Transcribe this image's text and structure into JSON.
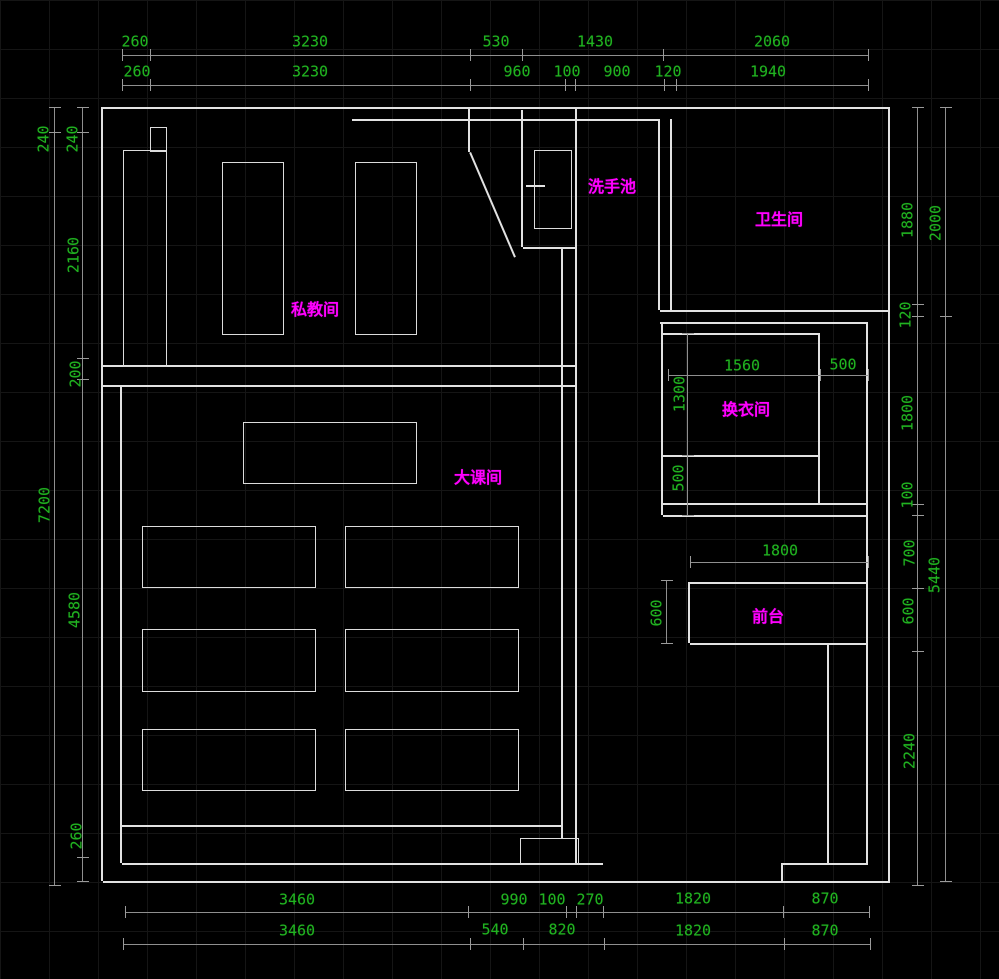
{
  "app": {
    "type": "cad-floor-plan",
    "units": "mm"
  },
  "colors": {
    "background": "#000000",
    "grid": "#151515",
    "wall": "#e2e2e2",
    "dim_line": "#8f8f8f",
    "dim_text": "#21b321",
    "room_label": "#ff00ff"
  },
  "rooms": [
    {
      "key": "private-training-room",
      "label": "私教间",
      "x": 315,
      "y": 310
    },
    {
      "key": "group-class-room",
      "label": "大课间",
      "x": 478,
      "y": 478
    },
    {
      "key": "wash-basin",
      "label": "洗手池",
      "x": 612,
      "y": 187
    },
    {
      "key": "toilet",
      "label": "卫生间",
      "x": 779,
      "y": 220
    },
    {
      "key": "changing-room",
      "label": "换衣间",
      "x": 746,
      "y": 410
    },
    {
      "key": "front-desk",
      "label": "前台",
      "x": 768,
      "y": 617
    }
  ],
  "dim_labels": [
    {
      "group": "top-outer",
      "text": "260",
      "x": 135,
      "y": 42,
      "rot": false
    },
    {
      "group": "top-outer",
      "text": "3230",
      "x": 310,
      "y": 42,
      "rot": false
    },
    {
      "group": "top-outer",
      "text": "530",
      "x": 496,
      "y": 42,
      "rot": false
    },
    {
      "group": "top-outer",
      "text": "1430",
      "x": 595,
      "y": 42,
      "rot": false
    },
    {
      "group": "top-outer",
      "text": "2060",
      "x": 772,
      "y": 42,
      "rot": false
    },
    {
      "group": "top-inner",
      "text": "260",
      "x": 137,
      "y": 72,
      "rot": false
    },
    {
      "group": "top-inner",
      "text": "3230",
      "x": 310,
      "y": 72,
      "rot": false
    },
    {
      "group": "top-inner",
      "text": "960",
      "x": 517,
      "y": 72,
      "rot": false
    },
    {
      "group": "top-inner",
      "text": "100",
      "x": 567,
      "y": 72,
      "rot": false
    },
    {
      "group": "top-inner",
      "text": "900",
      "x": 617,
      "y": 72,
      "rot": false
    },
    {
      "group": "top-inner",
      "text": "120",
      "x": 668,
      "y": 72,
      "rot": false
    },
    {
      "group": "top-inner",
      "text": "1940",
      "x": 768,
      "y": 72,
      "rot": false
    },
    {
      "group": "bottom-upper",
      "text": "3460",
      "x": 297,
      "y": 900,
      "rot": false
    },
    {
      "group": "bottom-upper",
      "text": "990",
      "x": 514,
      "y": 900,
      "rot": false
    },
    {
      "group": "bottom-upper",
      "text": "100",
      "x": 552,
      "y": 900,
      "rot": false
    },
    {
      "group": "bottom-upper",
      "text": "270",
      "x": 590,
      "y": 900,
      "rot": false
    },
    {
      "group": "bottom-upper",
      "text": "1820",
      "x": 693,
      "y": 899,
      "rot": false
    },
    {
      "group": "bottom-upper",
      "text": "870",
      "x": 825,
      "y": 899,
      "rot": false
    },
    {
      "group": "bottom-lower",
      "text": "3460",
      "x": 297,
      "y": 931,
      "rot": false
    },
    {
      "group": "bottom-lower",
      "text": "540",
      "x": 495,
      "y": 930,
      "rot": false
    },
    {
      "group": "bottom-lower",
      "text": "820",
      "x": 562,
      "y": 930,
      "rot": false
    },
    {
      "group": "bottom-lower",
      "text": "1820",
      "x": 693,
      "y": 931,
      "rot": false
    },
    {
      "group": "bottom-lower",
      "text": "870",
      "x": 825,
      "y": 931,
      "rot": false
    },
    {
      "group": "left-outer",
      "text": "240",
      "x": 44,
      "y": 139,
      "rot": true
    },
    {
      "group": "left-outer",
      "text": "7200",
      "x": 45,
      "y": 505,
      "rot": true
    },
    {
      "group": "left-inner",
      "text": "240",
      "x": 73,
      "y": 139,
      "rot": true
    },
    {
      "group": "left-inner",
      "text": "2160",
      "x": 74,
      "y": 255,
      "rot": true
    },
    {
      "group": "left-inner",
      "text": "200",
      "x": 76,
      "y": 374,
      "rot": true
    },
    {
      "group": "left-inner",
      "text": "4580",
      "x": 75,
      "y": 610,
      "rot": true
    },
    {
      "group": "left-inner",
      "text": "260",
      "x": 77,
      "y": 836,
      "rot": true
    },
    {
      "group": "right-inner",
      "text": "1880",
      "x": 908,
      "y": 220,
      "rot": true
    },
    {
      "group": "right-inner",
      "text": "120",
      "x": 906,
      "y": 315,
      "rot": true
    },
    {
      "group": "right-inner",
      "text": "1800",
      "x": 908,
      "y": 413,
      "rot": true
    },
    {
      "group": "right-inner",
      "text": "100",
      "x": 908,
      "y": 495,
      "rot": true
    },
    {
      "group": "right-inner",
      "text": "700",
      "x": 910,
      "y": 553,
      "rot": true
    },
    {
      "group": "right-inner",
      "text": "600",
      "x": 909,
      "y": 611,
      "rot": true
    },
    {
      "group": "right-inner",
      "text": "2240",
      "x": 910,
      "y": 751,
      "rot": true
    },
    {
      "group": "right-outer",
      "text": "2000",
      "x": 936,
      "y": 223,
      "rot": true
    },
    {
      "group": "right-outer",
      "text": "5440",
      "x": 935,
      "y": 575,
      "rot": true
    },
    {
      "group": "interior",
      "text": "1560",
      "x": 742,
      "y": 366,
      "rot": false
    },
    {
      "group": "interior",
      "text": "500",
      "x": 843,
      "y": 365,
      "rot": false
    },
    {
      "group": "interior",
      "text": "1300",
      "x": 680,
      "y": 394,
      "rot": true
    },
    {
      "group": "interior",
      "text": "500",
      "x": 679,
      "y": 478,
      "rot": true
    },
    {
      "group": "interior",
      "text": "1800",
      "x": 780,
      "y": 551,
      "rot": false
    },
    {
      "group": "interior",
      "text": "600",
      "x": 657,
      "y": 613,
      "rot": true
    }
  ],
  "dim_lines": [
    {
      "x1": 122,
      "y1": 55,
      "x2": 868,
      "y2": 55,
      "ticks": [
        122,
        150,
        470,
        522,
        663,
        868
      ]
    },
    {
      "x1": 122,
      "y1": 85,
      "x2": 868,
      "y2": 85,
      "ticks": [
        122,
        150,
        470,
        565,
        575,
        664,
        676,
        868
      ]
    },
    {
      "x1": 125,
      "y1": 912,
      "x2": 869,
      "y2": 912,
      "ticks": [
        125,
        468,
        566,
        576,
        603,
        783,
        869
      ]
    },
    {
      "x1": 123,
      "y1": 944,
      "x2": 870,
      "y2": 944,
      "ticks": [
        123,
        470,
        523,
        604,
        784,
        870
      ]
    },
    {
      "x1": 55,
      "y1": 107,
      "x2": 55,
      "y2": 885,
      "ticks": [
        107,
        132,
        885
      ]
    },
    {
      "x1": 83,
      "y1": 107,
      "x2": 83,
      "y2": 881,
      "ticks": [
        107,
        132,
        358,
        379,
        857,
        881
      ]
    },
    {
      "x1": 918,
      "y1": 107,
      "x2": 918,
      "y2": 885,
      "ticks": [
        107,
        304,
        316,
        504,
        515,
        588,
        651,
        885
      ]
    },
    {
      "x1": 946,
      "y1": 107,
      "x2": 946,
      "y2": 881,
      "ticks": [
        107,
        316,
        881
      ]
    },
    {
      "x1": 668,
      "y1": 375,
      "x2": 868,
      "y2": 375,
      "ticks": [
        668,
        820,
        868
      ]
    },
    {
      "x1": 688,
      "y1": 333,
      "x2": 688,
      "y2": 515,
      "ticks": [
        333,
        455,
        515
      ]
    },
    {
      "x1": 690,
      "y1": 562,
      "x2": 868,
      "y2": 562,
      "ticks": [
        690,
        868
      ]
    },
    {
      "x1": 667,
      "y1": 580,
      "x2": 667,
      "y2": 643,
      "ticks": [
        580,
        643
      ]
    }
  ],
  "walls": [
    [
      103,
      107,
      890,
      107
    ],
    [
      890,
      107,
      890,
      881
    ],
    [
      103,
      881,
      890,
      881
    ],
    [
      103,
      107,
      103,
      881
    ],
    [
      103,
      365,
      577,
      365
    ],
    [
      103,
      385,
      577,
      385
    ],
    [
      577,
      107,
      577,
      863
    ],
    [
      563,
      248,
      563,
      838
    ],
    [
      523,
      110,
      523,
      247
    ],
    [
      523,
      247,
      577,
      247
    ],
    [
      471,
      152,
      516,
      257
    ],
    [
      470,
      107,
      470,
      152
    ],
    [
      526,
      185,
      545,
      185
    ],
    [
      352,
      119,
      660,
      119
    ],
    [
      660,
      119,
      660,
      310
    ],
    [
      672,
      119,
      672,
      310
    ],
    [
      660,
      310,
      890,
      310
    ],
    [
      660,
      322,
      868,
      322
    ],
    [
      663,
      322,
      663,
      515
    ],
    [
      820,
      333,
      820,
      503
    ],
    [
      663,
      333,
      820,
      333
    ],
    [
      663,
      455,
      820,
      455
    ],
    [
      663,
      503,
      868,
      503
    ],
    [
      663,
      515,
      868,
      515
    ],
    [
      868,
      322,
      868,
      863
    ],
    [
      690,
      582,
      868,
      582
    ],
    [
      690,
      582,
      690,
      643
    ],
    [
      690,
      643,
      868,
      643
    ],
    [
      829,
      643,
      829,
      863
    ],
    [
      122,
      385,
      122,
      863
    ],
    [
      122,
      825,
      563,
      825
    ],
    [
      122,
      863,
      603,
      863
    ],
    [
      783,
      863,
      868,
      863
    ],
    [
      783,
      863,
      783,
      881
    ]
  ],
  "fixtures": [
    {
      "name": "wall-column",
      "x": 123,
      "y": 150,
      "w": 42,
      "h": 215
    },
    {
      "name": "wall-notch",
      "x": 150,
      "y": 127,
      "w": 15,
      "h": 23
    },
    {
      "name": "equipment-rect-1",
      "x": 222,
      "y": 162,
      "w": 60,
      "h": 171
    },
    {
      "name": "equipment-rect-2",
      "x": 355,
      "y": 162,
      "w": 60,
      "h": 171
    },
    {
      "name": "basin-door",
      "x": 534,
      "y": 150,
      "w": 36,
      "h": 77
    },
    {
      "name": "class-mat-top",
      "x": 243,
      "y": 422,
      "w": 172,
      "h": 60
    },
    {
      "name": "class-mat-r1c1",
      "x": 142,
      "y": 526,
      "w": 172,
      "h": 60
    },
    {
      "name": "class-mat-r1c2",
      "x": 345,
      "y": 526,
      "w": 172,
      "h": 60
    },
    {
      "name": "class-mat-r2c1",
      "x": 142,
      "y": 629,
      "w": 172,
      "h": 61
    },
    {
      "name": "class-mat-r2c2",
      "x": 345,
      "y": 629,
      "w": 172,
      "h": 61
    },
    {
      "name": "class-mat-r3c1",
      "x": 142,
      "y": 729,
      "w": 172,
      "h": 60
    },
    {
      "name": "class-mat-r3c2",
      "x": 345,
      "y": 729,
      "w": 172,
      "h": 60
    },
    {
      "name": "bottom-step-box",
      "x": 520,
      "y": 838,
      "w": 57,
      "h": 25
    }
  ]
}
